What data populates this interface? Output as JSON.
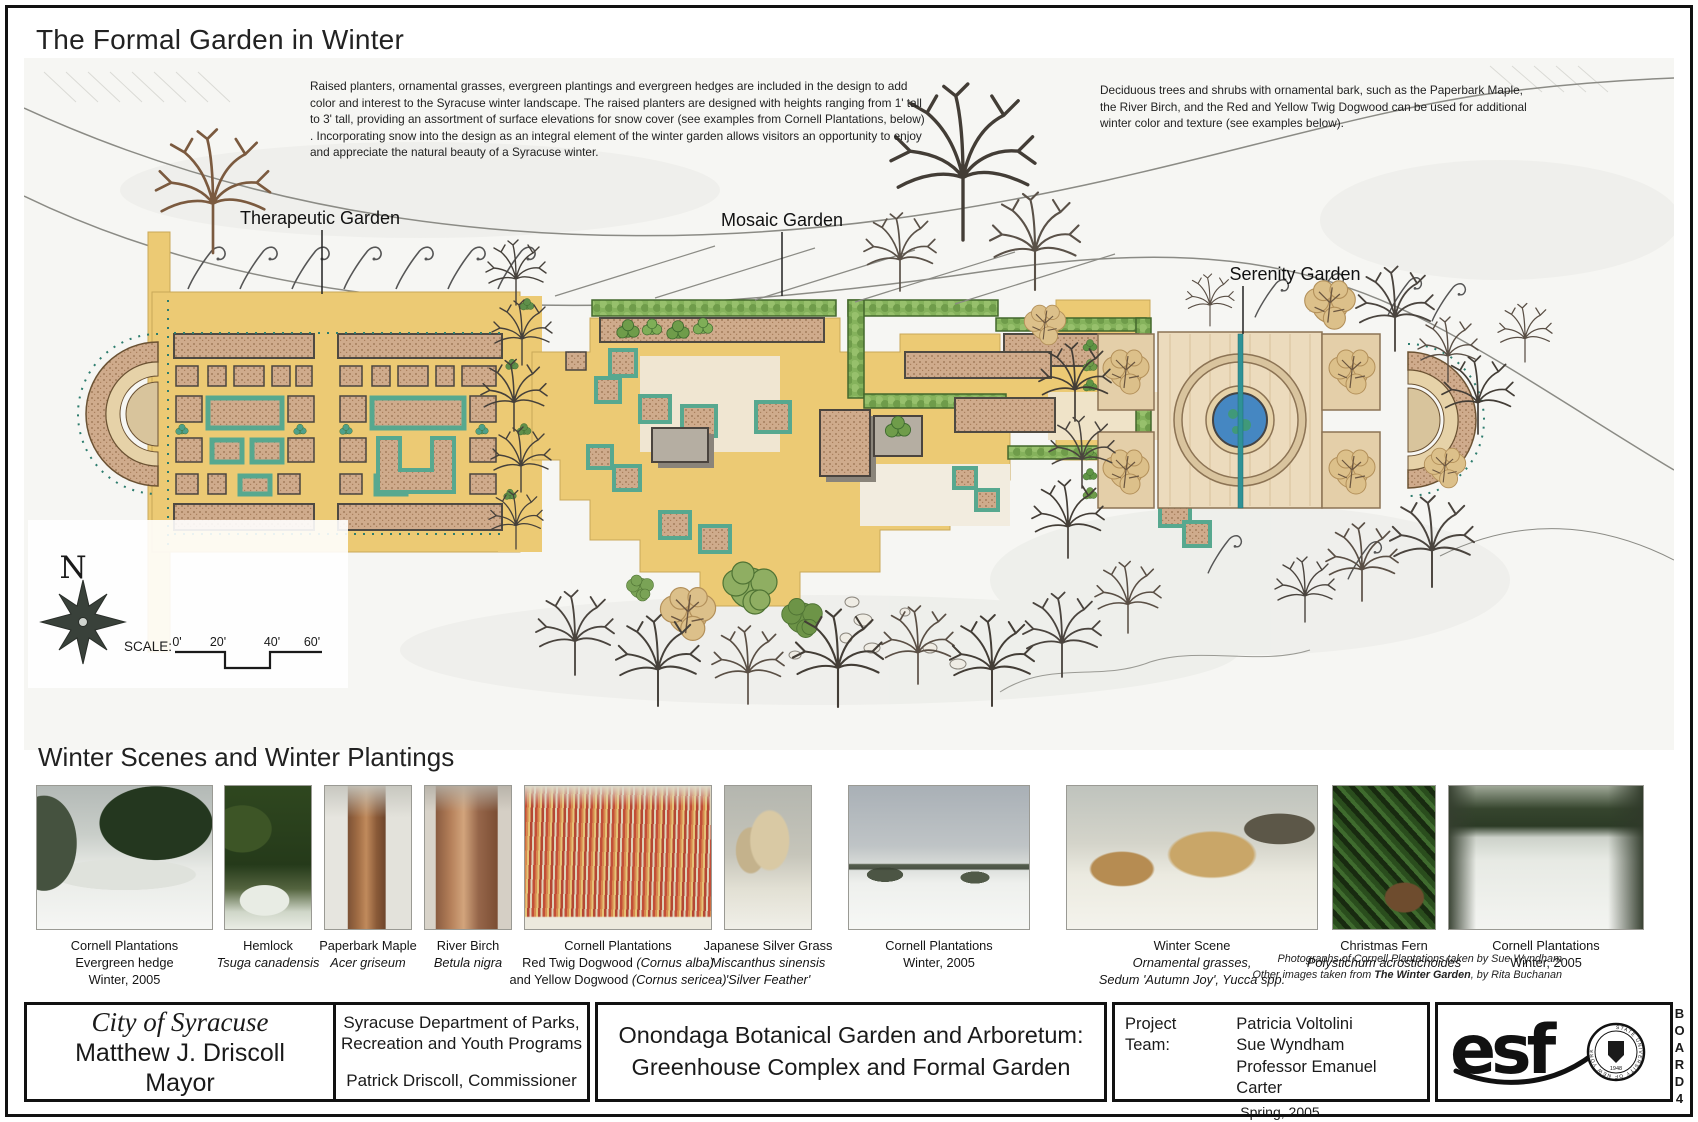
{
  "board": {
    "title": "The Formal Garden in Winter",
    "intro_left": "Raised planters, ornamental grasses, evergreen plantings and evergreen hedges are included in the design to add color and interest to the Syracuse winter landscape.  The raised planters are designed with heights ranging from 1' tall to 3' tall, providing an assortment of surface elevations for snow cover (see examples from Cornell Plantations, below) . Incorporating snow into the design as an integral element of the winter garden allows visitors an opportunity to enjoy and appreciate the natural beauty of a Syracuse winter.",
    "intro_right": "Deciduous trees and shrubs with ornamental bark, such as the Paperbark Maple, the River Birch, and the Red and Yellow Twig Dogwood can be used for additional winter color and texture (see examples below)."
  },
  "plan": {
    "labels": {
      "therapeutic": "Therapeutic Garden",
      "mosaic": "Mosaic Garden",
      "serenity": "Serenity Garden"
    },
    "north": "N",
    "scale_label": "SCALE:",
    "ticks": [
      "0'",
      "20'",
      "40'",
      "60'"
    ]
  },
  "gallery": {
    "heading": "Winter Scenes and Winter Plantings",
    "photos": [
      {
        "l1": "Cornell Plantations",
        "l2": "Evergreen hedge",
        "l3": "Winter, 2005"
      },
      {
        "l1": "Hemlock",
        "l2": "Tsuga canadensis"
      },
      {
        "l1": "Paperbark Maple",
        "l2": "Acer griseum"
      },
      {
        "l1": "River Birch",
        "l2": "Betula nigra"
      },
      {
        "l1": "Cornell Plantations",
        "l2a": "Red Twig Dogwood ",
        "l2b": "(Cornus alba)",
        "l3a": "and Yellow Dogwood ",
        "l3b": "(Cornus sericea)"
      },
      {
        "l1": "Japanese Silver Grass",
        "l2": "Miscanthus sinensis",
        "l3": "'Silver Feather'"
      },
      {
        "l1": "Cornell Plantations",
        "l2": "Winter, 2005"
      },
      {
        "l1": "Winter Scene",
        "l2": "Ornamental grasses,",
        "l3": "Sedum 'Autumn Joy', Yucca spp."
      },
      {
        "l1": "Christmas Fern",
        "l2": "Polystichum acrostichoides"
      },
      {
        "l1": "Cornell Plantations",
        "l2": "Winter, 2005"
      }
    ],
    "credits": {
      "line1": "Photographs of Cornell Plantations taken by Sue Wyndham",
      "line2_prefix": "Other images taken from ",
      "line2_emph": "The Winter Garden",
      "line2_suffix": ", by Rita Buchanan"
    }
  },
  "footer": {
    "city_line1": "City of Syracuse",
    "city_line2": "Matthew J. Driscoll",
    "city_line3": "Mayor",
    "dept_line1": "Syracuse Department of  Parks,",
    "dept_line2": "Recreation and Youth Programs",
    "dept_line3": "Patrick Driscoll, Commissioner",
    "title_line1": "Onondaga Botanical Garden and Arboretum:",
    "title_line2": "Greenhouse Complex and Formal Garden",
    "team_label": "Project Team:",
    "team_1": "Patricia Voltolini",
    "team_2": "Sue Wyndham",
    "team_3": "Professor Emanuel Carter",
    "team_4": "Spring,  2005",
    "logo": "esf",
    "seal_text": "STATE UNIVERSITY OF NEW YORK",
    "seal_year": "1948",
    "board_letters": "BOARD",
    "board_number": "4"
  }
}
